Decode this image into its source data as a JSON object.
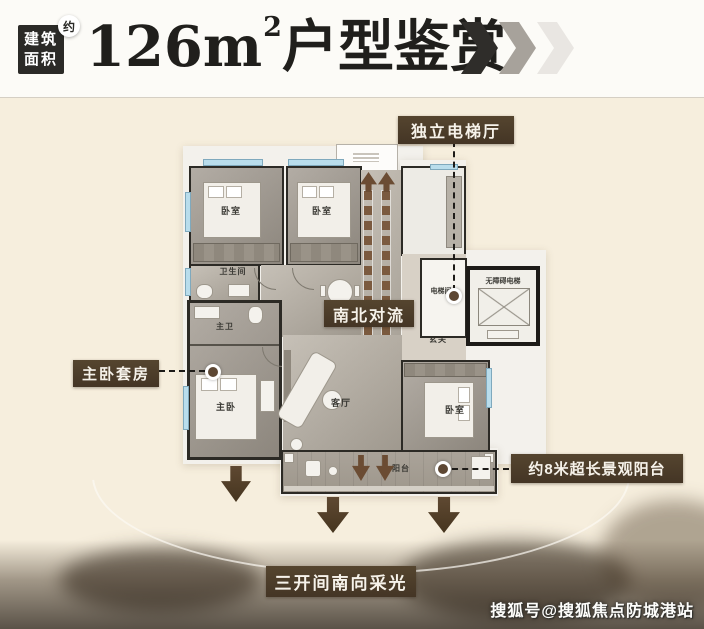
{
  "header": {
    "badge": {
      "line1": "建筑",
      "line2": "面积",
      "approx": "约"
    },
    "title": {
      "number": "126m",
      "superscript": "2",
      "suffix": "户型鉴赏"
    }
  },
  "annotations": {
    "elevator_hall": "独立电梯厅",
    "convection": "南北对流",
    "master_suite": "主卧套房",
    "long_balcony": "约8米超长景观阳台",
    "south_lighting": "三开间南向采光"
  },
  "floorplan": {
    "rooms": {
      "bedroom_top_left": "卧室",
      "bedroom_top_mid": "卧室",
      "bathroom": "卫生间",
      "master_bath": "主卫",
      "master_bedroom": "主卧",
      "living_room": "客厅",
      "bedroom_right": "卧室",
      "foyer": "玄关",
      "elevator_lobby": "电梯间",
      "accessible_elevator": "无障碍电梯",
      "balcony": "阳台"
    }
  },
  "watermark": "搜狐号@搜狐焦点防城港站",
  "colors": {
    "label_background": "#4b3c2c",
    "arrow_brown": "#55402c",
    "ladder_brown": "#7b5a3f",
    "window_blue": "#b9ddec",
    "wall_dark": "#2c2a25",
    "chevron_dark": "#2f2d2a",
    "chevron_mid": "#a7a29b",
    "chevron_light": "#e9e6e2"
  }
}
